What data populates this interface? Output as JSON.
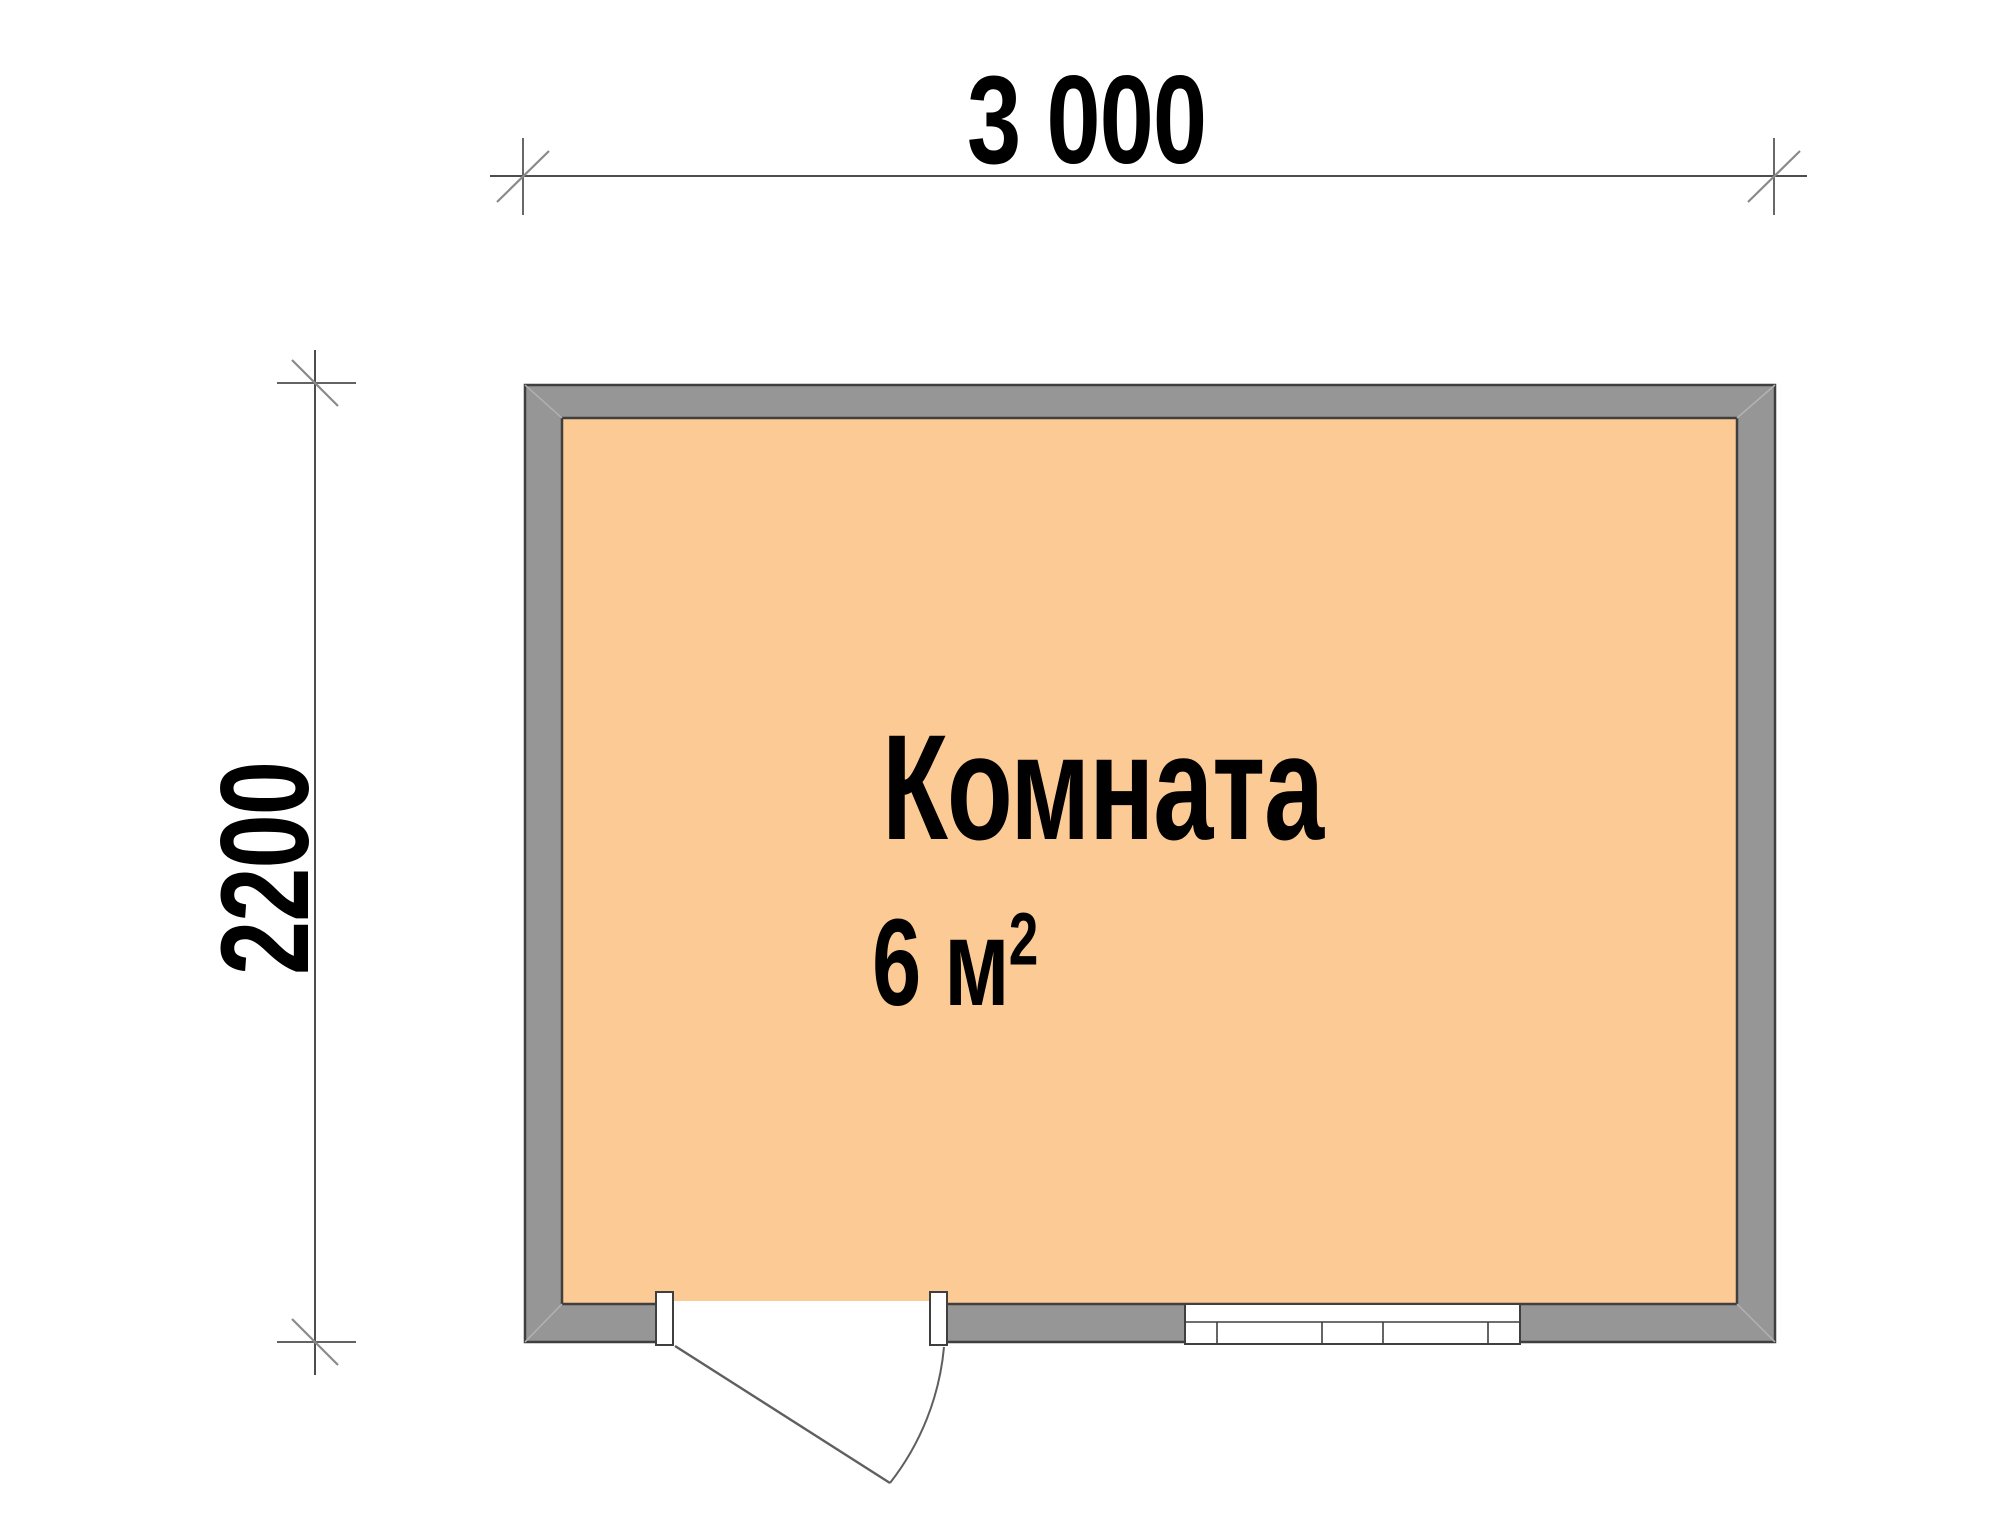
{
  "drawing": {
    "type": "floor-plan",
    "room": {
      "label": "Комната",
      "area_value": "6 м",
      "area_superscript": "2"
    },
    "dimensions": {
      "width_label": "3 000",
      "height_label": "2200"
    },
    "colors": {
      "background": "#ffffff",
      "room_fill": "#fcca95",
      "wall_fill": "#969696",
      "wall_outline": "#3f3f3f",
      "dimension_line": "#4d4d4d",
      "tick_slash": "#8a8a8a",
      "miter_line": "#b2b2b2",
      "door_window_line": "#5f5f5f",
      "text": "#000000"
    },
    "symbols": {
      "door": "door-swing-symbol",
      "window": "window-symbol"
    }
  }
}
